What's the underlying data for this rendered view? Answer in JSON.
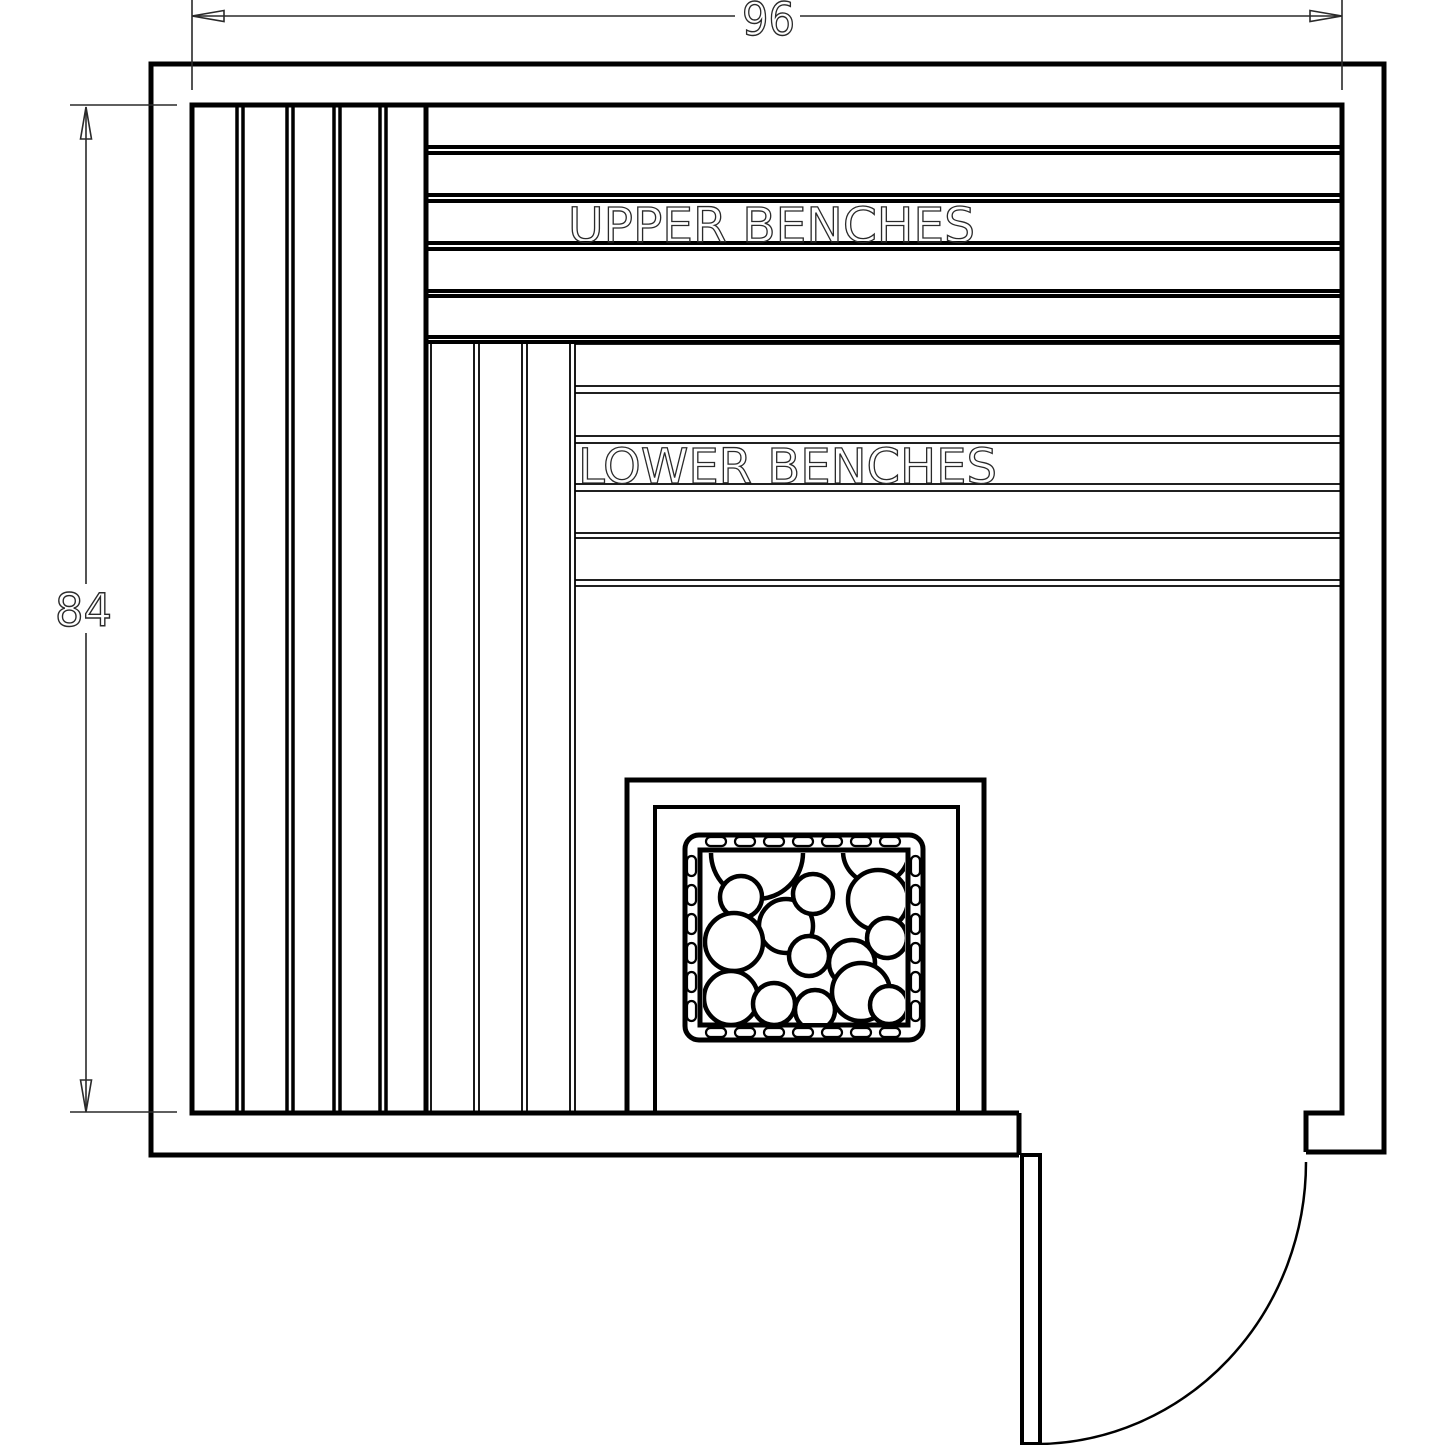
{
  "colors": {
    "line": "#000000",
    "dim_line": "#2a2a2a",
    "background": "#ffffff"
  },
  "dimensions": {
    "width": {
      "label": "96"
    },
    "height": {
      "label": "84"
    }
  },
  "labels": {
    "upper_benches": "UPPER BENCHES",
    "lower_benches": "LOWER BENCHES"
  }
}
